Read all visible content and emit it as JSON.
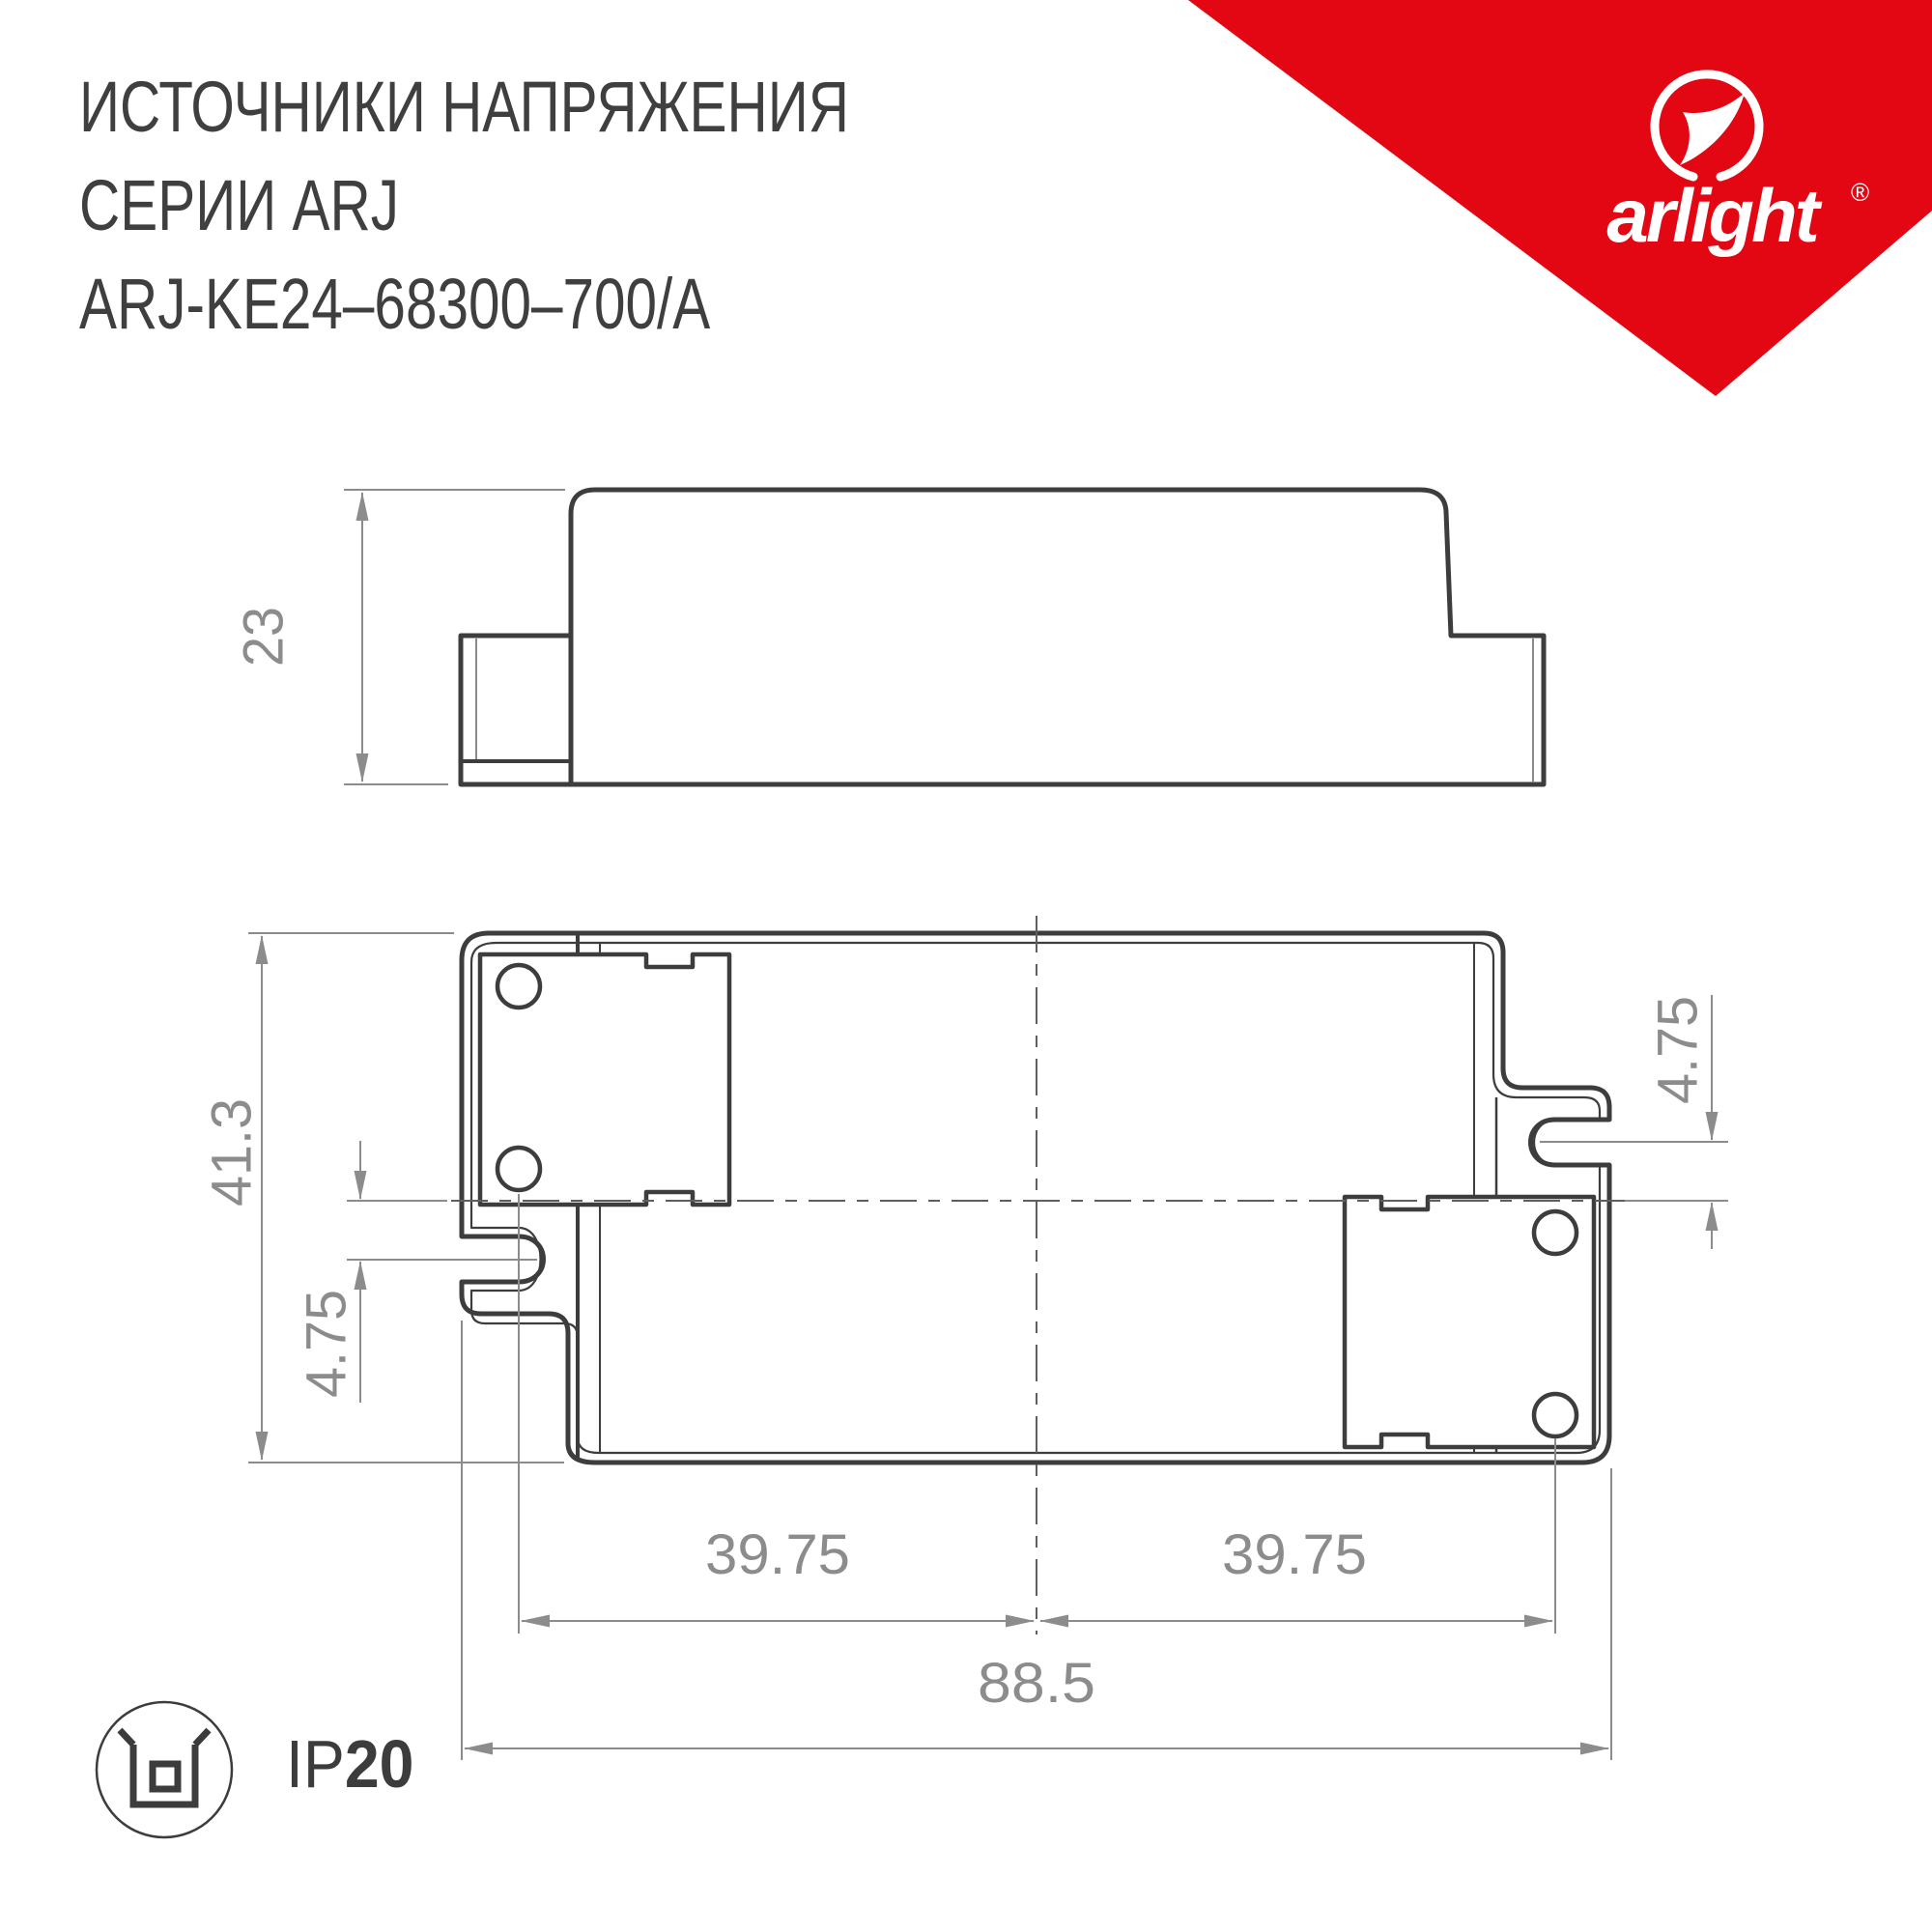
{
  "header": {
    "title_lines": [
      "ИСТОЧНИКИ НАПРЯЖЕНИЯ",
      "СЕРИИ ARJ",
      "ARJ-KE24–68300–700/A"
    ]
  },
  "brand": {
    "wordmark": "arlight",
    "registered_mark": "®",
    "triangle_color": "#E30613"
  },
  "views": {
    "side": {
      "height_mm": "23"
    },
    "plan": {
      "height_mm": "41.3",
      "slot_offset_left_mm": "4.75",
      "slot_offset_right_mm": "4.75",
      "hole_span_left_mm": "39.75",
      "hole_span_right_mm": "39.75",
      "overall_width_mm": "88.5"
    }
  },
  "footer": {
    "ip_label": "IP",
    "ip_value": "20"
  }
}
